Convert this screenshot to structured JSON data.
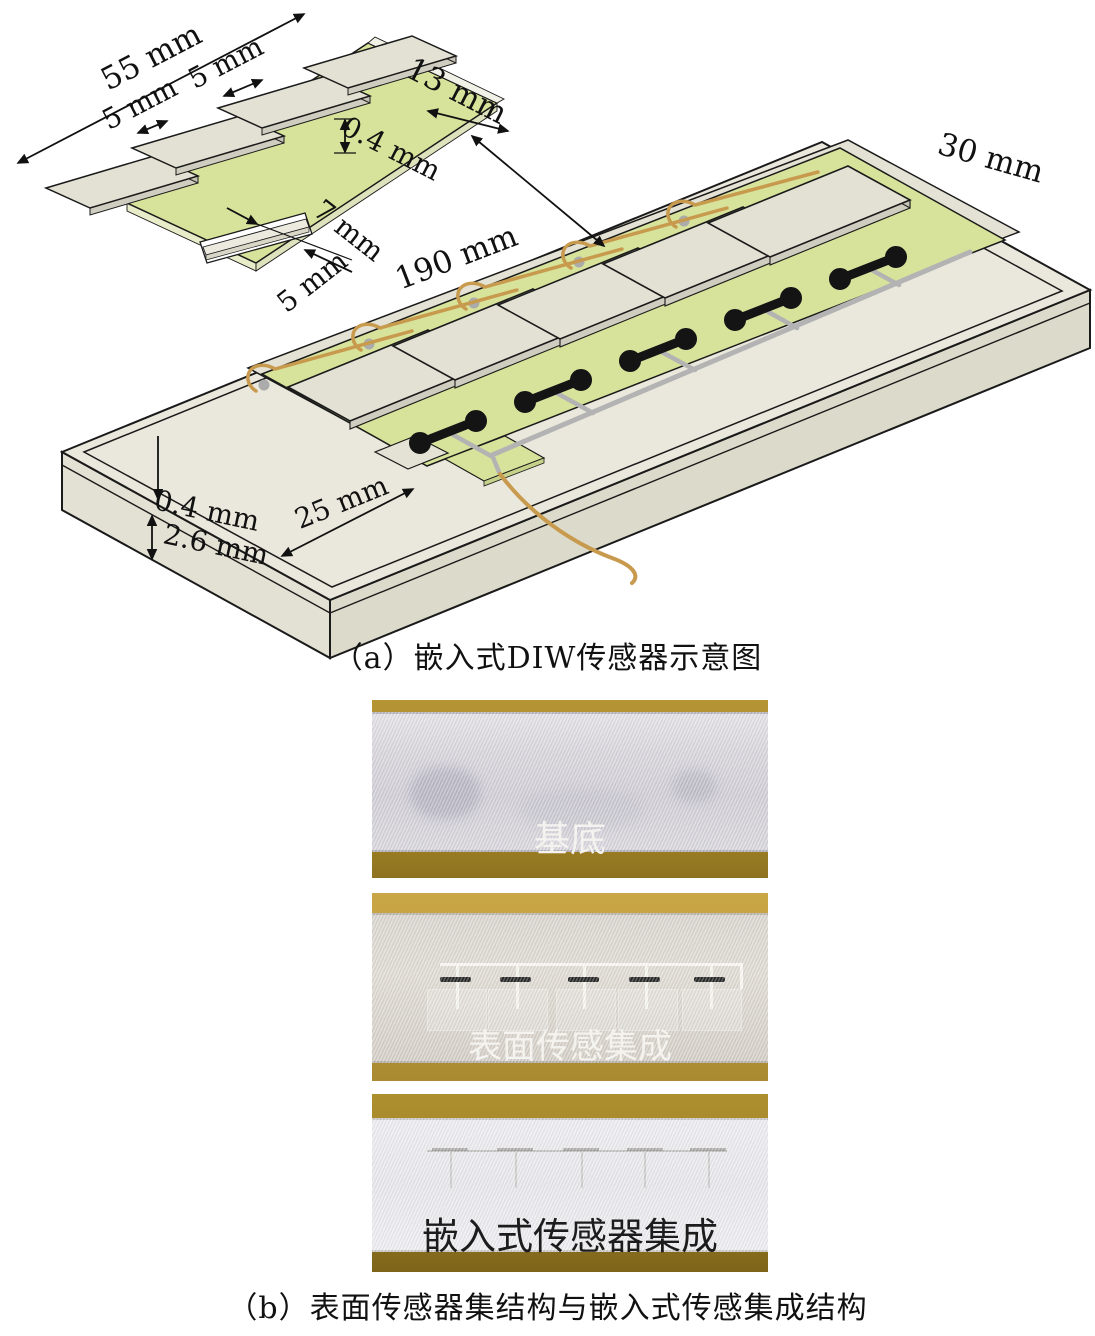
{
  "figure": {
    "panel_a": {
      "caption": "（a）嵌入式DIW传感器示意图",
      "inset_dims": {
        "overall_length": "55 mm",
        "pad_gap": "5 mm",
        "pad_gap_left": "5 mm",
        "pad_width": "13 mm",
        "membrane_thickness": "0.4 mm",
        "tab_length": "7 mm",
        "tab_width": "5 mm"
      },
      "slab_dims": {
        "length": "190 mm",
        "width": "30 mm",
        "recess_offset": "25 mm",
        "top_layer_thickness": "0.4 mm",
        "base_thickness": "2.6 mm"
      }
    },
    "panel_b": {
      "caption": "（b）表面传感器集结构与嵌入式传感集成结构",
      "photos": [
        {
          "label": "基底"
        },
        {
          "label": "表面传感集成"
        },
        {
          "label": "嵌入式传感器集成"
        }
      ]
    },
    "colors": {
      "membrane_green": "#d7e29a",
      "slab_beige": "#eae8dc",
      "pad_grey": "#e3e1d4",
      "wire_gold": "#c79a4e",
      "trace_grey": "#b3b3b3",
      "electrode_black": "#141414",
      "photo_brass": "#b5943a",
      "outline": "#1a1a1a"
    }
  }
}
